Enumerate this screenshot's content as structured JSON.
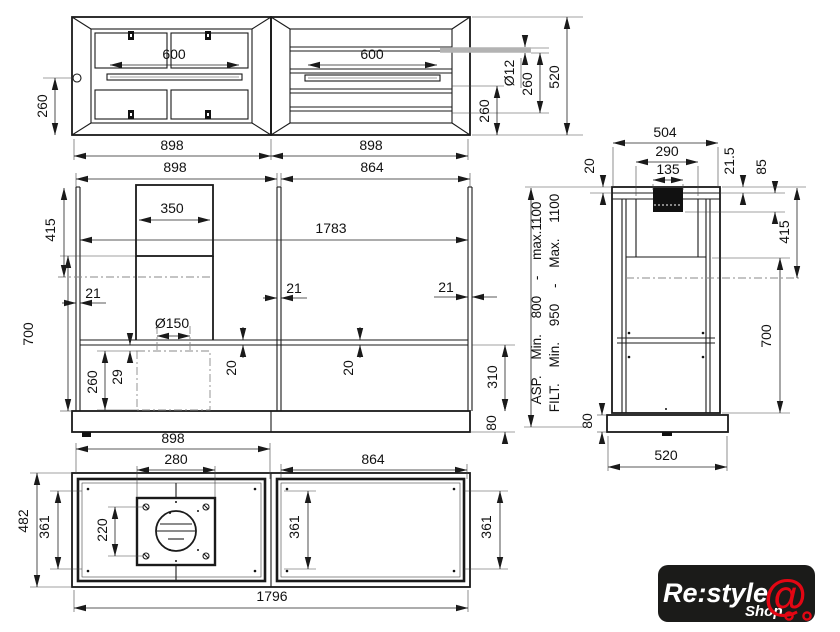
{
  "dims": {
    "top": {
      "rail_left": "600",
      "rail_right": "600",
      "depth_left": "260",
      "width_left": "898",
      "width_right": "898",
      "rod_dia": "Ø12",
      "rod_offset": "260",
      "rear_offset": "260",
      "depth_total": "520"
    },
    "front": {
      "width_left": "898",
      "width_right": "864",
      "chimney_width": "350",
      "inner_width": "1783",
      "upper_height": "415",
      "thickness_left": "21",
      "thickness_mid": "21",
      "thickness_right": "21",
      "body_height": "700",
      "duct_dia": "Ø150",
      "box_height": "260",
      "box_gap": "29",
      "shelf_thickness_left": "20",
      "shelf_thickness_right": "20",
      "lower_height": "310",
      "base_height": "80"
    },
    "side": {
      "depth_top": "504",
      "inner_depth": "290",
      "slot_depth": "135",
      "panel_thickness": "20",
      "slot_inset": "21.5",
      "slot_height": "85",
      "upper_height": "415",
      "body_height": "700",
      "base_height": "80",
      "base_depth": "520",
      "note_asp": "ASP. Min. 800 - max.1100",
      "note_filt": "FILT. Min. 950 - Max. 1100"
    },
    "bottom": {
      "width_left": "898",
      "plate_width": "280",
      "width_right": "864",
      "depth_total": "482",
      "inner_depth_left": "361",
      "plate_depth": "220",
      "inner_depth_mid": "361",
      "inner_depth_right": "361",
      "width_total": "1796"
    }
  },
  "logo": {
    "brand": "Re:style",
    "shop": "Shop",
    "cart": "@"
  },
  "colors": {
    "line": "#1a1a1a",
    "accent_red": "#e30613",
    "logo_bg": "#1b1b19",
    "rod_gray": "#b3b3b3"
  }
}
